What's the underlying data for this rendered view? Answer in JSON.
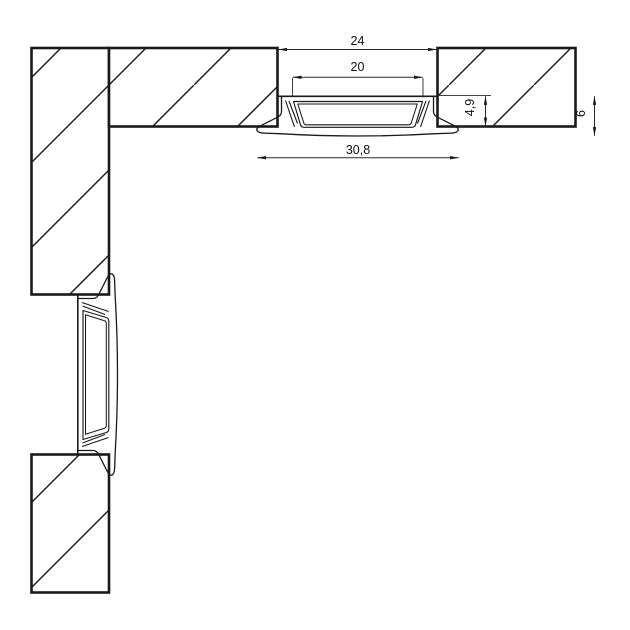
{
  "page": {
    "background": "#ffffff"
  },
  "drawing": {
    "type": "technical-section-drawing",
    "subject": "recessed-led-profile-corner-installation",
    "colors": {
      "line": "#1a1a1a",
      "dimension_line": "#2a2a2a",
      "background": "#ffffff"
    },
    "dimensions": {
      "groove_width": "24",
      "opening_width": "20",
      "flange_width": "30,8",
      "recess_depth": "4,9",
      "profile_height": "6"
    }
  }
}
